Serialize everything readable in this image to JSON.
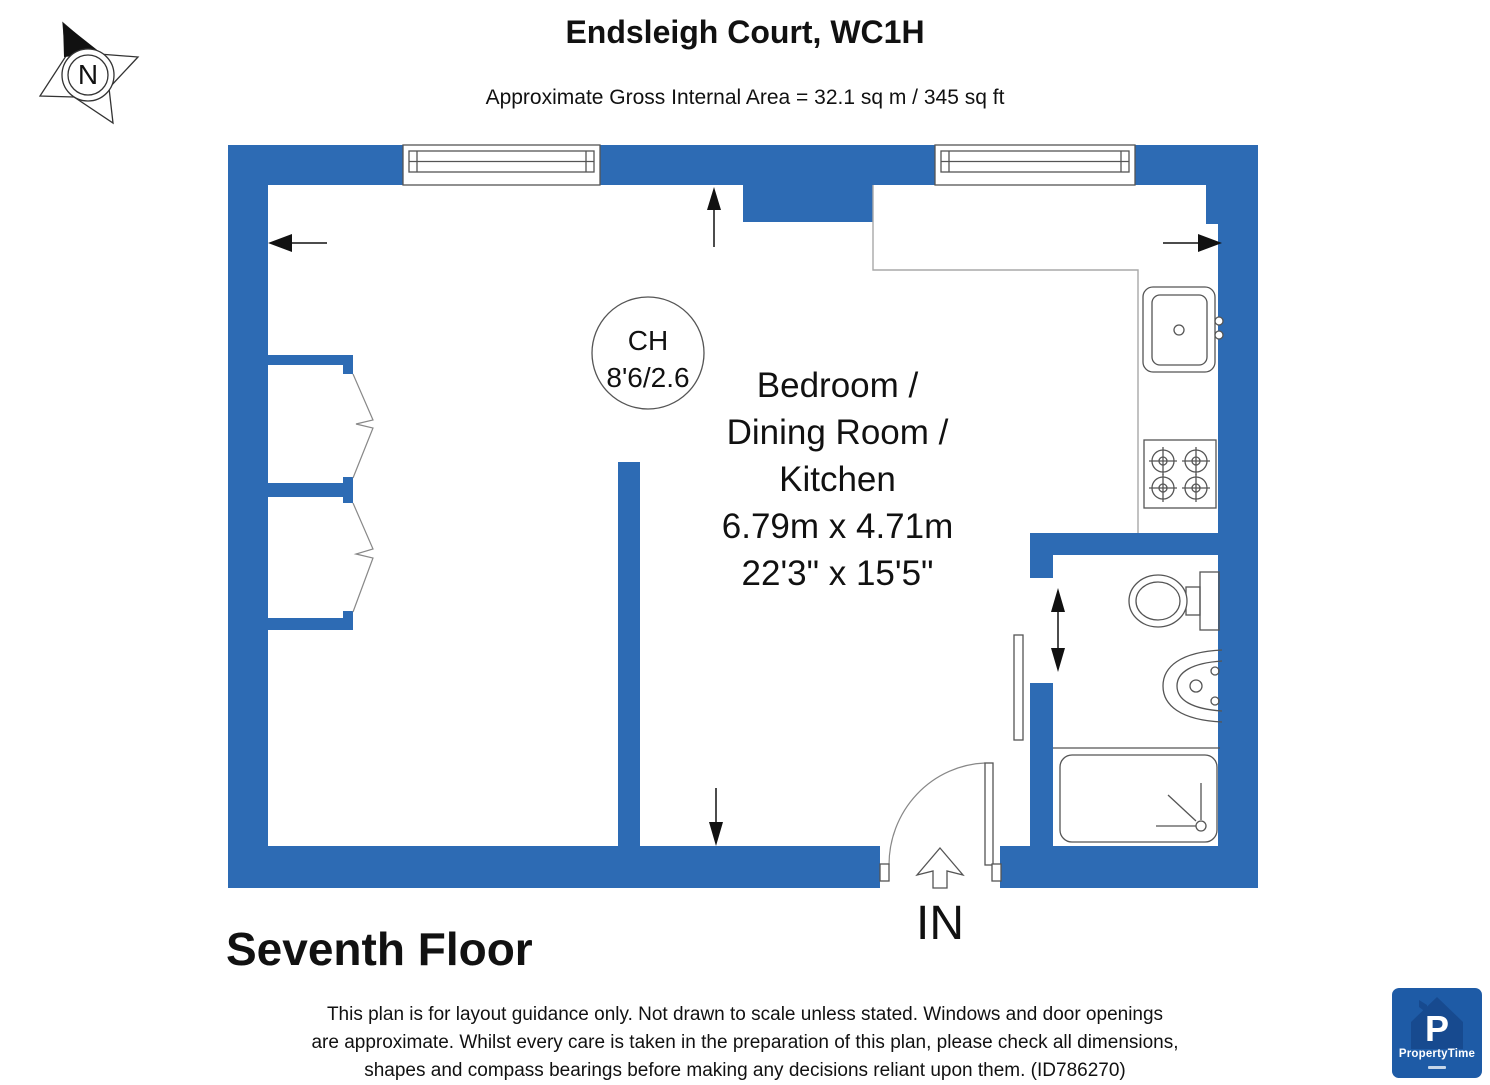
{
  "header": {
    "title": "Endsleigh Court, WC1H",
    "subtitle": "Approximate Gross Internal Area = 32.1 sq m / 345 sq ft"
  },
  "compass": {
    "north_label": "N"
  },
  "plan": {
    "room": {
      "name_line1": "Bedroom /",
      "name_line2": "Dining Room /",
      "name_line3": "Kitchen",
      "dimensions_metric": "6.79m x 4.71m",
      "dimensions_imperial": "22'3\" x 15'5\""
    },
    "ceiling_height": {
      "label": "CH",
      "value": "8'6/2.6"
    },
    "entrance_label": "IN"
  },
  "floor_label": "Seventh Floor",
  "disclaimer": {
    "line1": "This plan is for layout guidance only. Not drawn to scale unless stated. Windows and door openings",
    "line2": "are approximate. Whilst every care is taken in the preparation of this plan, please check all dimensions,",
    "line3": "shapes and compass bearings before making any decisions reliant upon them. (ID786270)"
  },
  "logo": {
    "brand": "PropertyTime",
    "monogram": "P"
  },
  "colors": {
    "wall": "#2d6bb4",
    "logo_bg": "#1e5ba6",
    "logo_house": "#174a8f"
  }
}
